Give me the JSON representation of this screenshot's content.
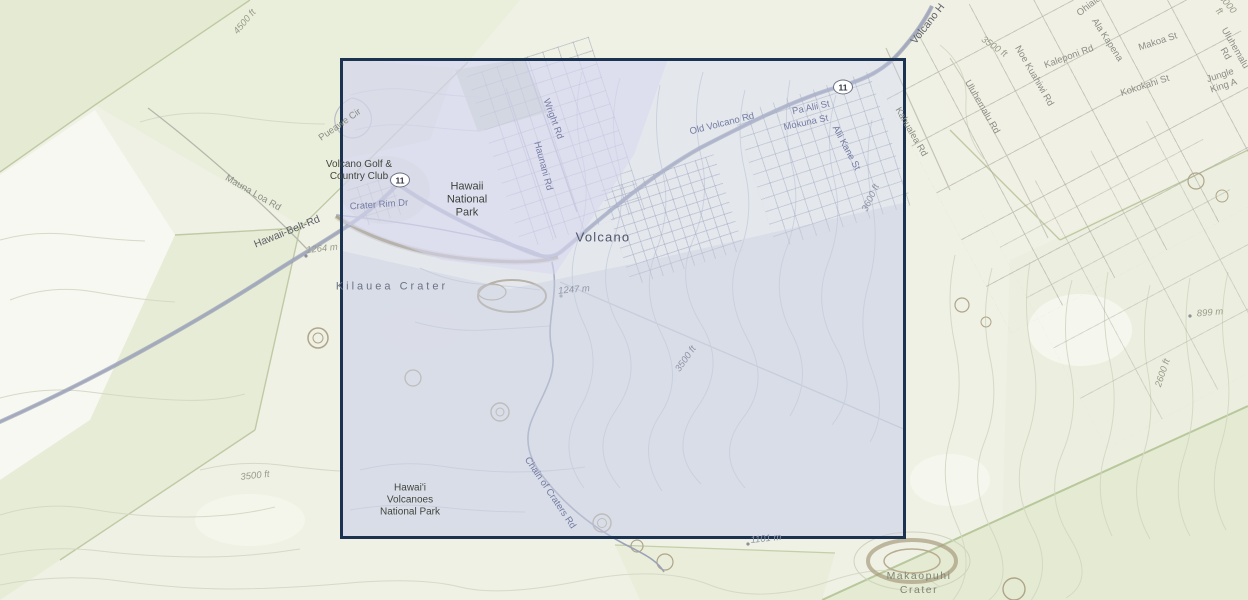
{
  "map": {
    "places": {
      "volcano_golf_club": "Volcano Golf &\nCountry Club",
      "hawaii_national_park": "Hawaii\nNational\nPark",
      "volcano_town": "Volcano",
      "kilauea_crater": "Kilauea Crater",
      "hawaii_volcanoes_national_park": "Hawai'i\nVolcanoes\nNational Park",
      "makaopuhi_crater": "Makaopuhi\nCrater"
    },
    "roads": {
      "mauna_loa_rd": "Mauna Loa Rd",
      "hawaii_belt_rd": "Hawaii-Belt-Rd",
      "crater_rim_dr": "Crater Rim Dr",
      "pueawe_cir": "Pueawe Cir",
      "wright_rd": "Wright Rd",
      "haunani_rd": "Haunani Rd",
      "old_volcano_rd": "Old Volcano Rd",
      "pa_alii_st": "Pa Alii St",
      "mokuna_st": "Mokuna St",
      "alii_kane_st": "Alii Kane St",
      "kahualea_rd": "Kahualea Rd",
      "volcano_hwy": "Volcano H",
      "chain_of_craters_rd": "Chain of Craters Rd",
      "uluhemalu_rd": "Uluhemalu Rd",
      "noe_kuahiwi_rd": "Noe Kuahiwi Rd",
      "kaleponi_rd": "Kaleponi Rd",
      "ala_kapena": "Ala Kapena",
      "ohiala": "Ohiala",
      "makoa_st": "Makoa St",
      "kokokahi_st": "Kokokahi St",
      "jungle_king_ave": "Jungle King A"
    },
    "elevations": {
      "ft_4500": "4500 ft",
      "m_1264": "1264 m",
      "m_1247": "1247 m",
      "ft_3500_center": "3500 ft",
      "ft_3600": "3600 ft",
      "ft_3500_southwest": "3500 ft",
      "ft_3500_northeast": "3500 ft",
      "ft_2600": "2600 ft",
      "m_899": "899 m",
      "m_1101": "1101 m",
      "ft_3000": "3000 ft"
    },
    "route_shield_label": "11",
    "colors": {
      "selection_border": "#1b3250",
      "selection_fill": "rgba(203,208,233,0.32)",
      "map_background": "#eff1e4",
      "highway": "#8f96ac"
    }
  }
}
